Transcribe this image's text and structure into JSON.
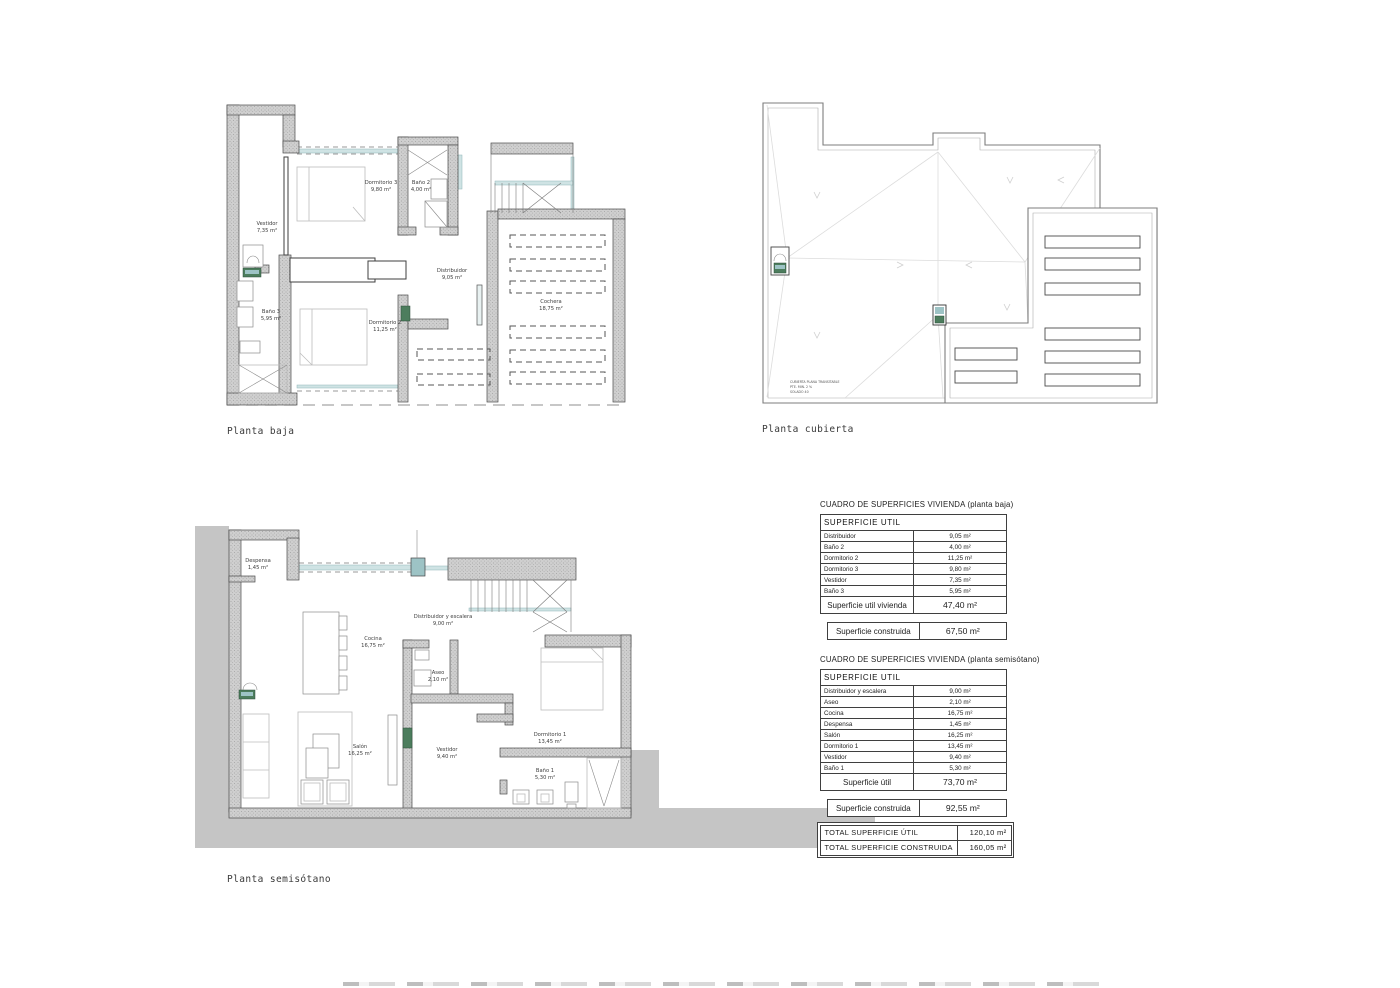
{
  "sheet": {
    "background": "#ffffff"
  },
  "plans": {
    "baja": {
      "caption": "Planta baja",
      "rooms": {
        "vestidor": {
          "name": "Vestidor",
          "area": "7,35 m²"
        },
        "dormitorio3": {
          "name": "Dormitorio 3",
          "area": "9,80 m²"
        },
        "bano2": {
          "name": "Baño 2",
          "area": "4,00 m²"
        },
        "bano3": {
          "name": "Baño 3",
          "area": "5,95 m²"
        },
        "dormitorio2": {
          "name": "Dormitorio 2",
          "area": "11,25 m²"
        },
        "distribuidor": {
          "name": "Distribuidor",
          "area": "9,05 m²"
        },
        "cochera": {
          "name": "Cochera",
          "area": "18,75 m²"
        }
      }
    },
    "cubierta": {
      "caption": "Planta cubierta",
      "note_line1": "CUBIERTA PLANA TRANSITABLE",
      "note_line2": "PTE. MIN. 2 %",
      "note_line3": "SOLADO 40"
    },
    "semisotano": {
      "caption": "Planta semisótano",
      "rooms": {
        "despensa": {
          "name": "Despensa",
          "area": "1,45 m²"
        },
        "cocina": {
          "name": "Cocina",
          "area": "16,75 m²"
        },
        "distribuidor": {
          "name": "Distribuidor y escalera",
          "area": "9,00 m²"
        },
        "aseo": {
          "name": "Aseo",
          "area": "2,10 m²"
        },
        "salon": {
          "name": "Salón",
          "area": "16,25 m²"
        },
        "vestidor": {
          "name": "Vestidor",
          "area": "9,40 m²"
        },
        "dormitorio1": {
          "name": "Dormitorio 1",
          "area": "13,45 m²"
        },
        "bano1": {
          "name": "Baño 1",
          "area": "5,30 m²"
        }
      }
    }
  },
  "surface_tables": {
    "baja": {
      "title": "CUADRO DE SUPERFICIES VIVIENDA (planta baja)",
      "header": "SUPERFICIE  UTIL",
      "rows": [
        {
          "label": "Distribuidor",
          "value": "9,05 m²"
        },
        {
          "label": "Baño 2",
          "value": "4,00 m²"
        },
        {
          "label": "Dormitorio 2",
          "value": "11,25 m²"
        },
        {
          "label": "Dormitorio 3",
          "value": "9,80 m²"
        },
        {
          "label": "Vestidor",
          "value": "7,35 m²"
        },
        {
          "label": "Baño 3",
          "value": "5,95 m²"
        }
      ],
      "subtotal": {
        "label": "Superficie util vivienda",
        "value": "47,40 m²"
      },
      "built": {
        "label": "Superficie construida",
        "value": "67,50 m²"
      }
    },
    "semisotano": {
      "title": "CUADRO DE SUPERFICIES VIVIENDA (planta semisótano)",
      "header": "SUPERFICIE  UTIL",
      "rows": [
        {
          "label": "Distribuidor y escalera",
          "value": "9,00 m²"
        },
        {
          "label": "Aseo",
          "value": "2,10 m²"
        },
        {
          "label": "Cocina",
          "value": "16,75 m²"
        },
        {
          "label": "Despensa",
          "value": "1,45 m²"
        },
        {
          "label": "Salón",
          "value": "16,25 m²"
        },
        {
          "label": "Dormitorio 1",
          "value": "13,45 m²"
        },
        {
          "label": "Vestidor",
          "value": "9,40 m²"
        },
        {
          "label": "Baño 1",
          "value": "5,30 m²"
        }
      ],
      "subtotal": {
        "label": "Superficie útil",
        "value": "73,70 m²"
      },
      "built": {
        "label": "Superficie construida",
        "value": "92,55 m²"
      }
    },
    "totals": {
      "rows": [
        {
          "label": "TOTAL SUPERFICIE  ÚTIL",
          "value": "120,10 m²"
        },
        {
          "label": "TOTAL SUPERFICIE  CONSTRUIDA",
          "value": "160,05 m²"
        }
      ]
    }
  }
}
